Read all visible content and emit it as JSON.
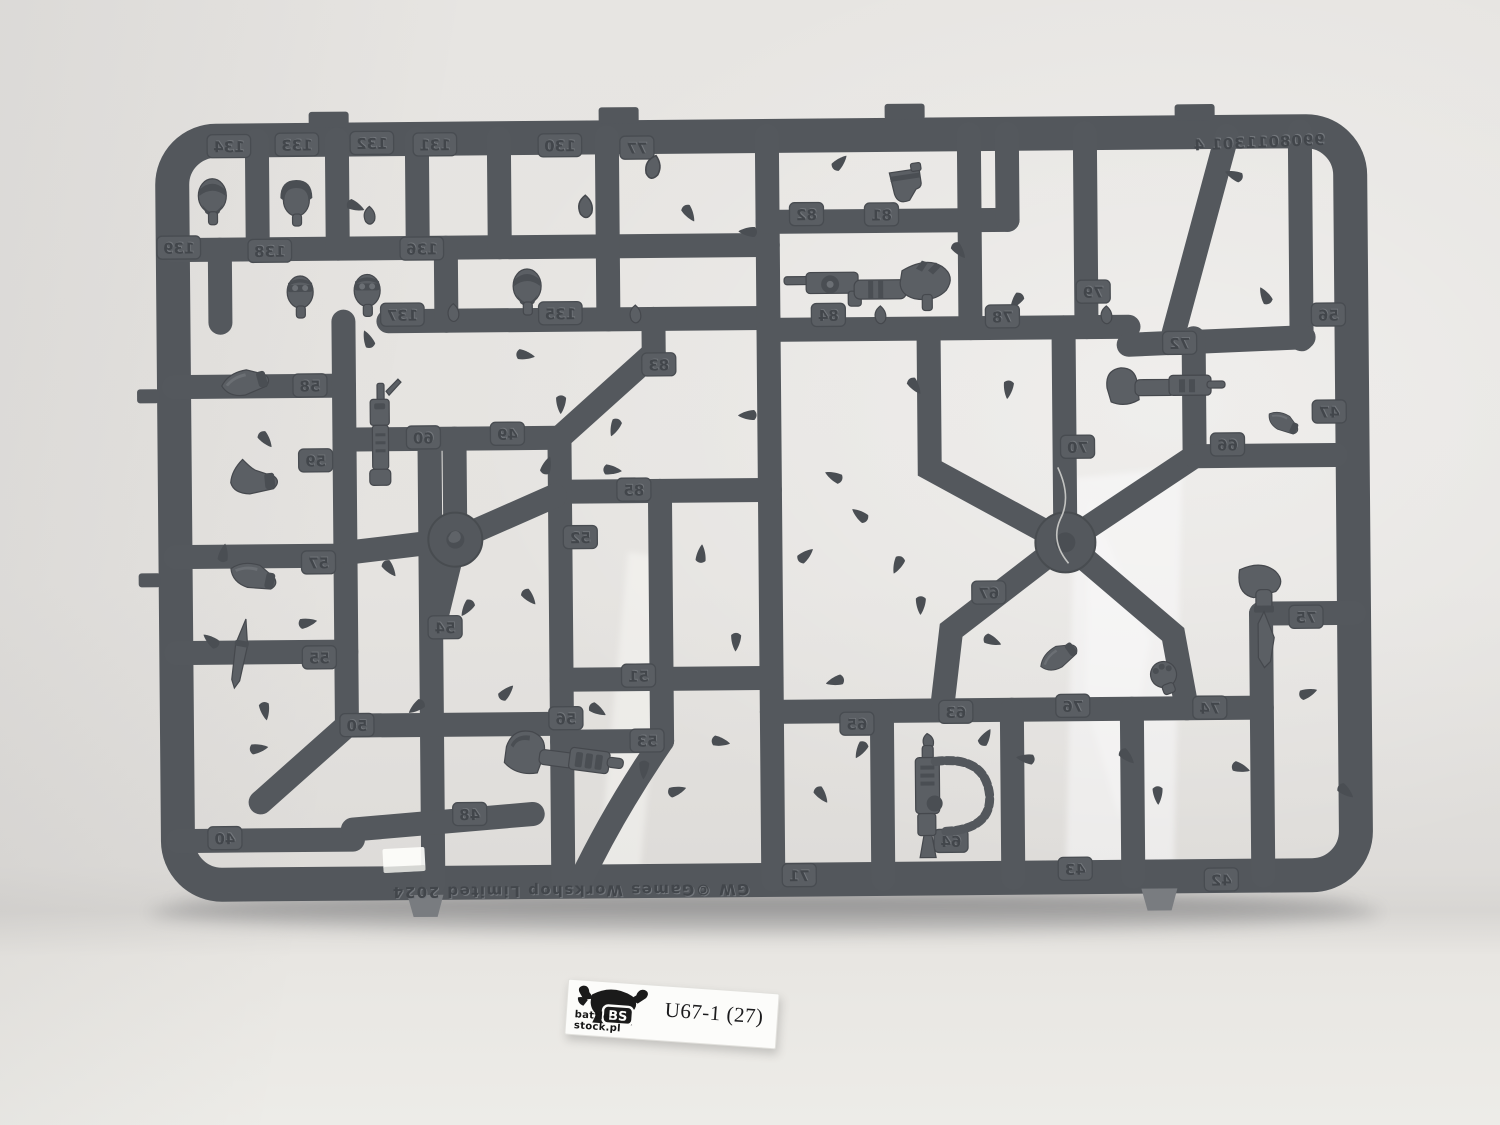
{
  "label": {
    "code": "U67-1 (27)",
    "site": "battle-stock.pl",
    "logo_text": "BS"
  },
  "sprue": {
    "copyright": "GW ©Games Workshop Limited 2024",
    "serial_number": "9908011301 4",
    "plastic_color": "#54585c",
    "part_color": "#5b5f64",
    "part_numbers": [
      {
        "label": "134",
        "x": 232,
        "y": 142
      },
      {
        "label": "133",
        "x": 300,
        "y": 141
      },
      {
        "label": "132",
        "x": 375,
        "y": 140
      },
      {
        "label": "131",
        "x": 438,
        "y": 142
      },
      {
        "label": "130",
        "x": 563,
        "y": 144
      },
      {
        "label": "77",
        "x": 640,
        "y": 147
      },
      {
        "label": "139",
        "x": 181,
        "y": 243
      },
      {
        "label": "138",
        "x": 272,
        "y": 247
      },
      {
        "label": "136",
        "x": 424,
        "y": 246
      },
      {
        "label": "137",
        "x": 404,
        "y": 312
      },
      {
        "label": "135",
        "x": 562,
        "y": 312
      },
      {
        "label": "58",
        "x": 311,
        "y": 382
      },
      {
        "label": "59",
        "x": 316,
        "y": 457
      },
      {
        "label": "60",
        "x": 424,
        "y": 435
      },
      {
        "label": "49",
        "x": 508,
        "y": 432
      },
      {
        "label": "83",
        "x": 660,
        "y": 364
      },
      {
        "label": "85",
        "x": 634,
        "y": 489
      },
      {
        "label": "52",
        "x": 580,
        "y": 536
      },
      {
        "label": "57",
        "x": 318,
        "y": 559
      },
      {
        "label": "54",
        "x": 444,
        "y": 625
      },
      {
        "label": "55",
        "x": 318,
        "y": 654
      },
      {
        "label": "50",
        "x": 355,
        "y": 722
      },
      {
        "label": "51",
        "x": 637,
        "y": 675
      },
      {
        "label": "56",
        "x": 564,
        "y": 717
      },
      {
        "label": "53",
        "x": 645,
        "y": 740
      },
      {
        "label": "48",
        "x": 467,
        "y": 812
      },
      {
        "label": "40",
        "x": 222,
        "y": 834
      },
      {
        "label": "82",
        "x": 809,
        "y": 215
      },
      {
        "label": "81",
        "x": 884,
        "y": 216
      },
      {
        "label": "84",
        "x": 830,
        "y": 316
      },
      {
        "label": "78",
        "x": 1004,
        "y": 319
      },
      {
        "label": "79",
        "x": 1095,
        "y": 295
      },
      {
        "label": "72",
        "x": 1181,
        "y": 347
      },
      {
        "label": "70",
        "x": 1078,
        "y": 450
      },
      {
        "label": "67",
        "x": 988,
        "y": 595
      },
      {
        "label": "66",
        "x": 1228,
        "y": 449
      },
      {
        "label": "56",
        "x": 1330,
        "y": 320
      },
      {
        "label": "47",
        "x": 1330,
        "y": 417
      },
      {
        "label": "65",
        "x": 855,
        "y": 725
      },
      {
        "label": "63",
        "x": 954,
        "y": 714
      },
      {
        "label": "76",
        "x": 1071,
        "y": 709
      },
      {
        "label": "74",
        "x": 1208,
        "y": 712
      },
      {
        "label": "75",
        "x": 1305,
        "y": 622
      },
      {
        "label": "71",
        "x": 796,
        "y": 876
      },
      {
        "label": "64",
        "x": 948,
        "y": 843
      },
      {
        "label": "43",
        "x": 1072,
        "y": 872
      },
      {
        "label": "42",
        "x": 1218,
        "y": 884
      }
    ],
    "parts": [
      {
        "name": "head-bearded",
        "shape": "head-bare",
        "x": 215,
        "y": 196
      },
      {
        "name": "head-helmeted",
        "shape": "head-helmet",
        "x": 299,
        "y": 198
      },
      {
        "name": "head-bandana-goggles",
        "shape": "head-goggles",
        "x": 302,
        "y": 291
      },
      {
        "name": "head-goggles",
        "shape": "head-goggles",
        "x": 369,
        "y": 290
      },
      {
        "name": "head-bearded-shades",
        "shape": "head-bare",
        "x": 529,
        "y": 289
      },
      {
        "name": "head-stub",
        "shape": "nub",
        "x": 372,
        "y": 212
      },
      {
        "name": "head-stub",
        "shape": "nub",
        "x": 455,
        "y": 310
      },
      {
        "name": "head-stub",
        "shape": "nub",
        "x": 637,
        "y": 313
      },
      {
        "name": "head-stub",
        "shape": "nub",
        "x": 882,
        "y": 316
      },
      {
        "name": "head-stub",
        "shape": "nub",
        "x": 1108,
        "y": 318
      },
      {
        "name": "hair-piece",
        "shape": "nub",
        "x": 588,
        "y": 205,
        "s": 1.25
      },
      {
        "name": "small-part",
        "shape": "nub",
        "x": 656,
        "y": 166,
        "s": 1.3,
        "rot": 15
      },
      {
        "name": "arm-shoulder-pad",
        "shape": "arm-pad",
        "x": 247,
        "y": 379,
        "rot": -15
      },
      {
        "name": "arm-hooded",
        "shape": "arm-hood",
        "x": 255,
        "y": 478,
        "rot": -5
      },
      {
        "name": "arm-with-cuff",
        "shape": "arm-pad",
        "x": 253,
        "y": 573,
        "rot": 12
      },
      {
        "name": "combat-knife",
        "shape": "knife",
        "x": 239,
        "y": 648,
        "rot": 10
      },
      {
        "name": "combi-weapon",
        "shape": "gun-vert",
        "x": 381,
        "y": 438
      },
      {
        "name": "arm-plasma-pistol",
        "shape": "arm-plasma",
        "x": 551,
        "y": 757,
        "rot": 8
      },
      {
        "name": "pistol-holster",
        "shape": "holster",
        "x": 908,
        "y": 186,
        "rot": -8
      },
      {
        "name": "arm-bolt-pistol",
        "shape": "arm-pistol",
        "x": 872,
        "y": 288
      },
      {
        "name": "arm-stub-gun",
        "shape": "arm-gun",
        "x": 1160,
        "y": 393
      },
      {
        "name": "arm-knife-down",
        "shape": "knife-arm",
        "x": 1265,
        "y": 608
      },
      {
        "name": "clenched-fist",
        "shape": "fist",
        "x": 1162,
        "y": 678,
        "rot": -20
      },
      {
        "name": "arm-elbow",
        "shape": "arm-pad",
        "x": 1058,
        "y": 660,
        "rot": -35,
        "s": 0.85
      },
      {
        "name": "arm-small",
        "shape": "arm-pad",
        "x": 1284,
        "y": 428,
        "rot": 25,
        "s": 0.7
      },
      {
        "name": "gun-with-ammo-feed",
        "shape": "gun-hose",
        "x": 925,
        "y": 797
      }
    ]
  },
  "background": {
    "backdrop_color": "#e6e4e1",
    "floor_color": "#edece8",
    "shadow_color": "#55565a"
  }
}
